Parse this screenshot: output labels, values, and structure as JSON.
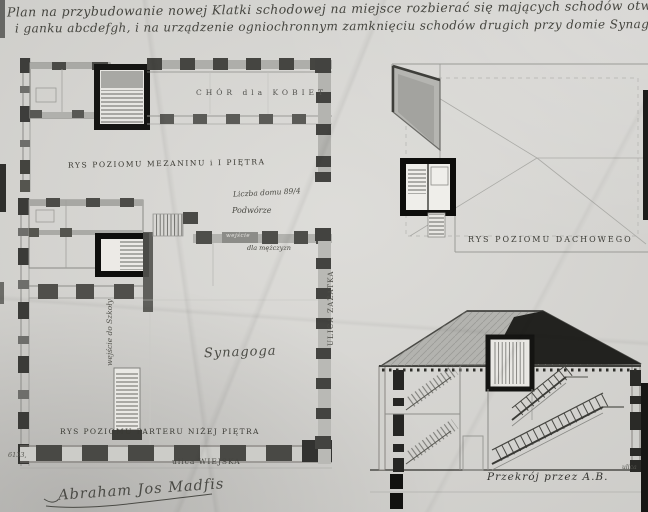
{
  "document": {
    "title_line1": "Plan na przybudowanie nowej Klatki schodowej na miejsce rozbierać się mających schodów otwart:",
    "title_line2": "i ganku abcdefgh, i na urządzenie ogniochronnym zamknięciu schodów drugich przy domie Synagogi № 87⅓."
  },
  "plans": {
    "mezzanine": {
      "caption": "RYS POZIOMU MEZANINU i I PIĘTRA",
      "room_label": "CHÓR dla KOBIET"
    },
    "ground": {
      "caption": "RYS POZIOMU PARTERU NIŻEJ PIĘTRA",
      "hall_label": "Synagoga",
      "courtyard_label": "Podwórze",
      "house_number": "Liczba domu 89/4",
      "door_tag": "wejście",
      "door_note": "dla mężczyzn",
      "side_entrance_note": "wejście do Szkoły"
    },
    "roof": {
      "caption": "RYS POZIOMU DACHOWEGO"
    },
    "section": {
      "caption": "Przekrój przez A.B.",
      "corner_note": "ulica"
    }
  },
  "streets": {
    "bottom": "ulica WIEJSKA",
    "right": "ULICA ZAŻATKA"
  },
  "signature": "Abraham Jos Madfis",
  "archive_number": "6133,",
  "colors": {
    "paper": "#d7d6d2",
    "ink": "#3d3d39",
    "wall_dark": "#2e2e2b",
    "wall_mid": "#8f8f8b"
  }
}
